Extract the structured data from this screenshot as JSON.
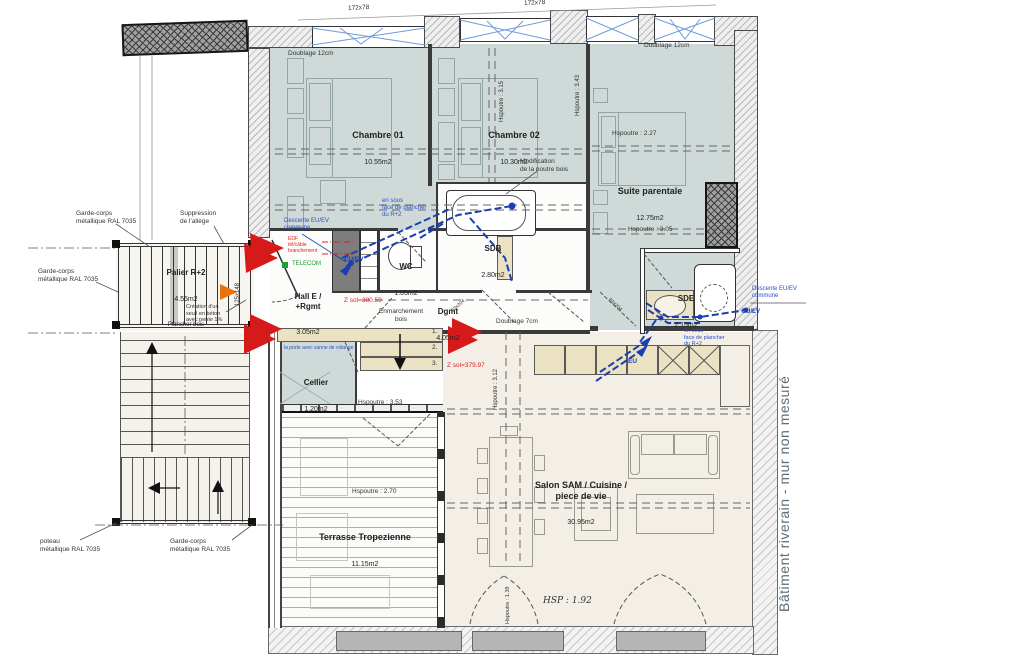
{
  "colors": {
    "floor_bedroom": "#cfdad8",
    "floor_living": "#f3efe6",
    "steps_beige": "#ebe2c3",
    "pipe_blue": "#1c3fb0",
    "note_blue": "#2a50c8",
    "alert_red": "#d61a1a",
    "telecom_green": "#18a02c",
    "orange_marker": "#e8720c",
    "riverain_text": "#5d6e78"
  },
  "rooms": {
    "ch01": {
      "name": "Chambre 01",
      "area": "10.55m2"
    },
    "ch02": {
      "name": "Chambre 02",
      "area": "10.30m2"
    },
    "suite": {
      "name": "Suite parentale",
      "area": "12.75m2"
    },
    "sdb": {
      "name": "SDB",
      "area": "2.80m2"
    },
    "wc": {
      "name": "WC",
      "area": "1.05m2"
    },
    "hall": {
      "name": "Hall E /\n+Rgmt",
      "area": "3.05m2"
    },
    "dgmt": {
      "name": "Dgmt",
      "area": "4.05m2"
    },
    "sde": {
      "name": "SDE",
      "area": "2.15m2"
    },
    "cellier": {
      "name": "Cellier",
      "area": "1.20m2"
    },
    "salon": {
      "name": "Salon SAM / Cuisine /\npiece de vie",
      "area": "30.95m2"
    },
    "terrasse": {
      "name": "Terrasse Tropezienne",
      "area": "11.15m2"
    },
    "palier": {
      "name": "Palier R+2",
      "area": "4.55m2",
      "note": "Plancher bois"
    }
  },
  "dims": {
    "velux": "172x78",
    "porte": "125x148",
    "door_a": "73x204",
    "door_b": "83x204"
  },
  "notes": {
    "doublage12": "Doublage 12cm",
    "doublage7": "Doublage 7cm",
    "hsp227": "Hspoutre : 2.27",
    "hsp305": "Hspoutre : 3.05",
    "hsp343": "Hspoutre : 3.43",
    "hsp315": "Hspoutre : 3.15",
    "hsp353": "Hspoutre : 3.53",
    "hsp312": "Hspoutre : 3.12",
    "hsp270": "Hspoutre : 2.70",
    "hsp139": "Hspoutre : 1.39",
    "hsp192": "HSP : 1.92",
    "zsol1": "Z sol=380.59",
    "zsol2": "Z sol=379.97",
    "modif": "Modification\nde la poutre bois",
    "suppression": "Suppression\nde l'allège",
    "gardecorps": "Garde-corps\nmétallique RAL 7035",
    "poteau": "poteau\nmétallique RAL 7035",
    "seuil": "Création d'un\nseuil en béton\navec pente 1%",
    "descente": "Descente EU/EV\ncommune",
    "sousface": "en sous\nface de plancher\ndu R+2",
    "euev": "EU/EV",
    "eu": "EU",
    "telecom": "TELECOM",
    "legend": "EDF\ntél/câble\nbranchement",
    "enmarchement": "Enmarchement\nbois",
    "vanne": "la porte avec vanne de vidange",
    "batiment": "Bâtiment riverain - mur non mesuré",
    "step1": "1.",
    "step2": "2.",
    "step3": "3."
  }
}
